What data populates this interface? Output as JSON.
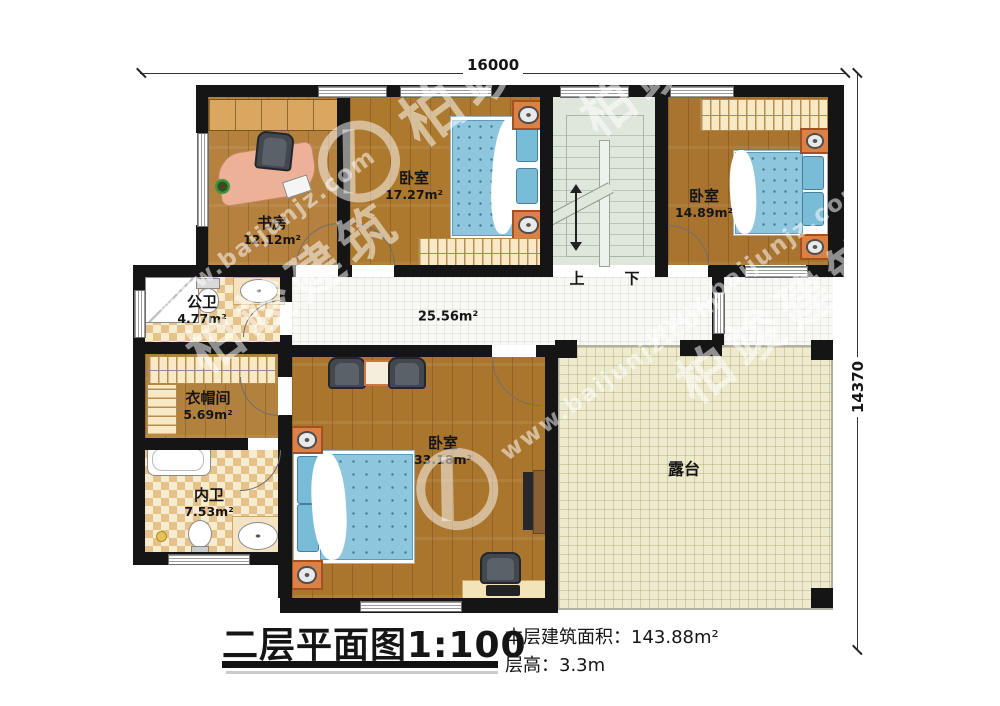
{
  "dimensions": {
    "top": "16000",
    "right": "14370"
  },
  "rooms": {
    "study": {
      "name": "书房",
      "area": "12.12m²"
    },
    "bedroom_mid": {
      "name": "卧室",
      "area": "17.27m²"
    },
    "bedroom_right": {
      "name": "卧室",
      "area": "14.89m²"
    },
    "public_bath": {
      "name": "公卫",
      "area": "4.77m²"
    },
    "hallway": {
      "area": "25.56m²"
    },
    "cloakroom": {
      "name": "衣帽间",
      "area": "5.69m²"
    },
    "private_bath": {
      "name": "内卫",
      "area": "7.53m²"
    },
    "master_bedroom": {
      "name": "卧室",
      "area": "33.18m²"
    },
    "terrace": {
      "name": "露台"
    }
  },
  "stairs": {
    "up_label": "上",
    "down_label": "下"
  },
  "title_block": {
    "title": "二层平面图1:100",
    "area_label": "本层建筑面积：",
    "area_value": "143.88m²",
    "height_label": "层高：",
    "height_value": "3.3m"
  },
  "watermark": {
    "brand": "柏竣建筑",
    "url": "www.baijunjz.com"
  },
  "colors": {
    "wall": "#151515",
    "wood": "#ad7a33",
    "bed": "#8ec6de",
    "tile": "#e6c28b",
    "terrace": "#edeacd",
    "stairs": "#dfe7dc"
  }
}
